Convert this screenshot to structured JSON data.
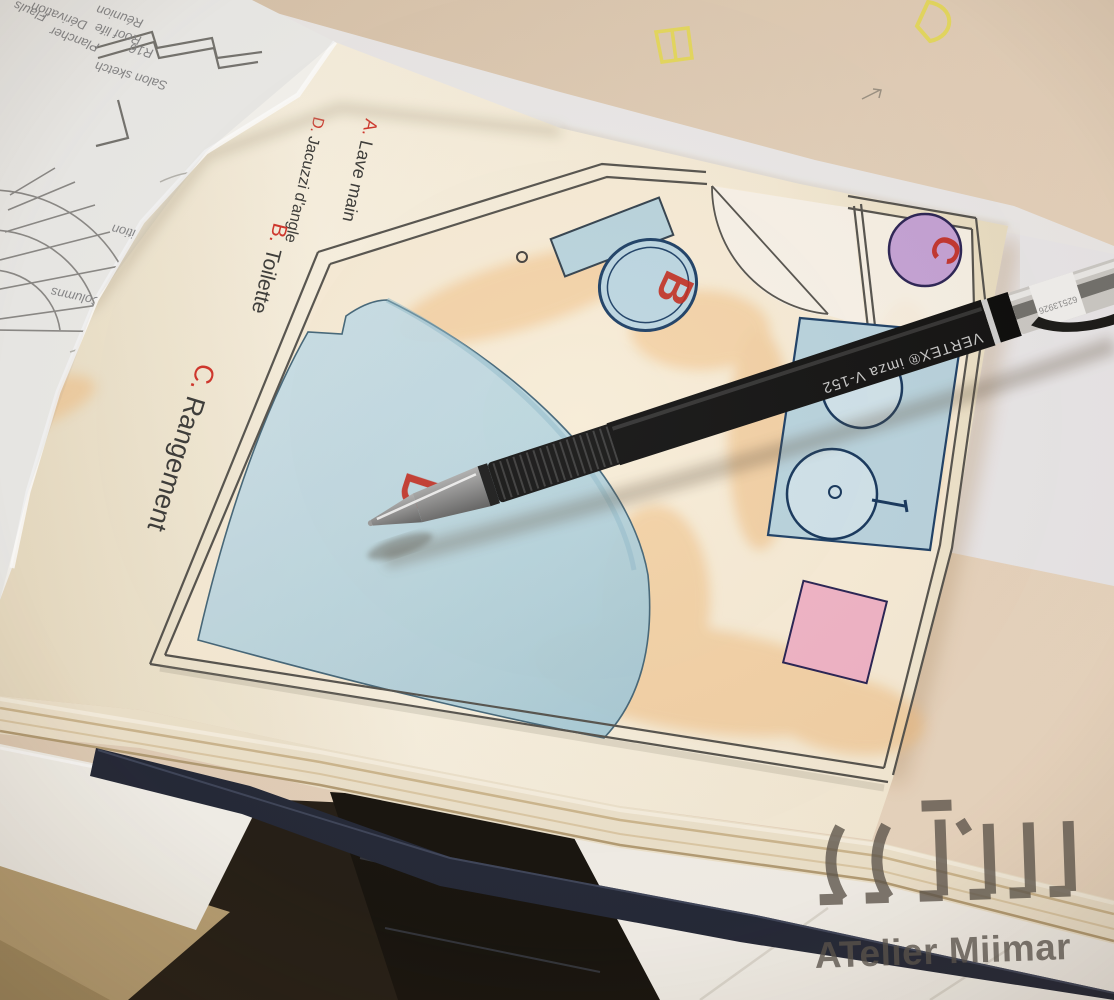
{
  "legend": {
    "items": [
      {
        "key": "A.",
        "label": "Lave main"
      },
      {
        "key": "D.",
        "label": "Jacuzzi d'angle"
      },
      {
        "key": "B.",
        "label": "Toilette"
      },
      {
        "key": "C.",
        "label": "Rangement"
      }
    ]
  },
  "plan": {
    "labels": {
      "a": "A",
      "b": "B",
      "c": "C",
      "d": "D"
    }
  },
  "pen": {
    "barrel_text": "VERTEX®  imza  V-152",
    "cap_code": "62513926"
  },
  "watermark": {
    "studio": "ATelier Miimar"
  },
  "notes": {
    "items": [
      "Columns",
      "PR",
      "Proposition",
      "Salon sketch",
      "R16",
      "Roof life",
      "Réunion",
      "Plancher",
      "Dérivation",
      "Flauls"
    ]
  },
  "colors": {
    "marker_red": "#c32a1d",
    "plan_blue": "#b9d6df",
    "plan_pink": "#f0b3c6",
    "plan_purple": "#c5a3d6",
    "cover_navy": "#232838",
    "watermark_gray": "#5b5349",
    "doodle_yellow": "#e6dc4a"
  }
}
